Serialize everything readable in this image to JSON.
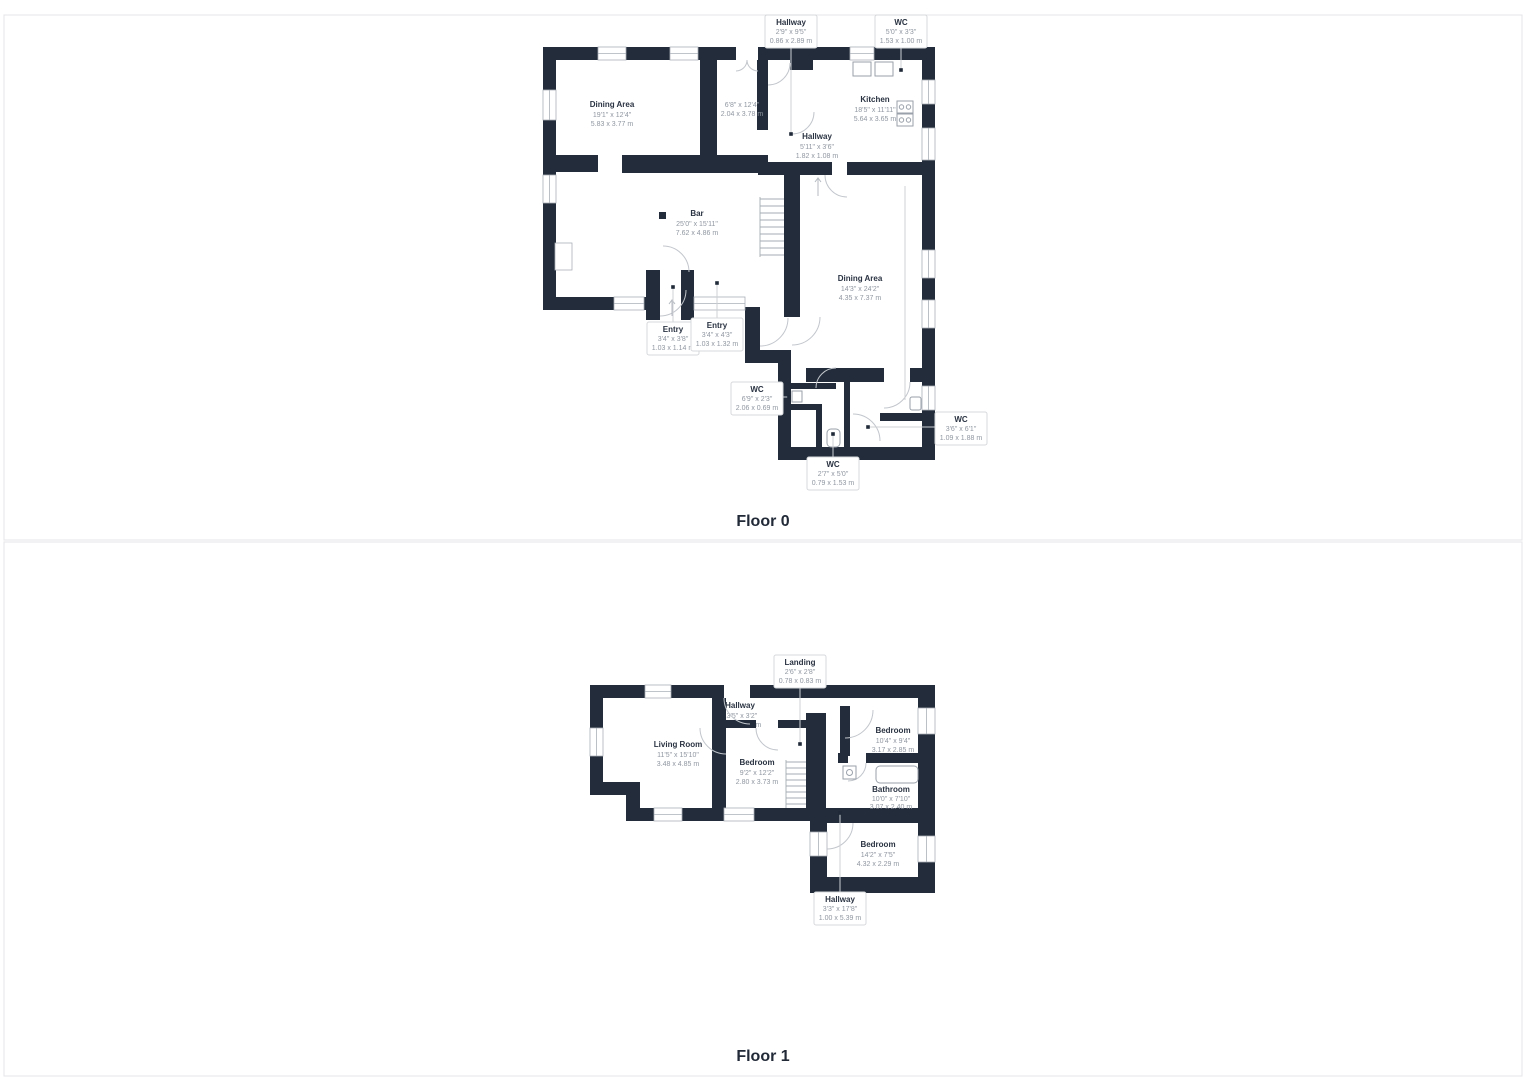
{
  "palette": {
    "wall": "#222c3a",
    "room_name_text": "#2a3342",
    "dimension_text": "#9097a1",
    "leader_line": "#cdd0d4",
    "label_box_border": "#d6d8db",
    "panel_border": "#e4e5e8",
    "background": "#ffffff"
  },
  "floors": [
    {
      "caption": "Floor 0",
      "rooms": [
        {
          "name": "Dining Area",
          "imperial": "19'1\" x 12'4\"",
          "metric": "5.83 x 3.77 m",
          "boxed": false
        },
        {
          "name": "",
          "imperial": "6'8\" x 12'4\"",
          "metric": "2.04 x 3.78 m",
          "boxed": false
        },
        {
          "name": "Kitchen",
          "imperial": "18'5\" x 11'11\"",
          "metric": "5.64 x 3.65 m",
          "boxed": false
        },
        {
          "name": "Hallway",
          "imperial": "5'11\" x 3'6\"",
          "metric": "1.82 x 1.08 m",
          "boxed": false
        },
        {
          "name": "Bar",
          "imperial": "25'0\" x 15'11\"",
          "metric": "7.62 x 4.86 m",
          "boxed": false
        },
        {
          "name": "Dining Area",
          "imperial": "14'3\" x 24'2\"",
          "metric": "4.35 x 7.37 m",
          "boxed": false
        },
        {
          "name": "Hallway",
          "imperial": "2'9\" x 9'5\"",
          "metric": "0.86 x 2.89 m",
          "boxed": true
        },
        {
          "name": "WC",
          "imperial": "5'0\" x 3'3\"",
          "metric": "1.53 x 1.00 m",
          "boxed": true
        },
        {
          "name": "Entry",
          "imperial": "3'4\" x 3'8\"",
          "metric": "1.03 x 1.14 m",
          "boxed": true
        },
        {
          "name": "Entry",
          "imperial": "3'4\" x 4'3\"",
          "metric": "1.03 x 1.32 m",
          "boxed": true
        },
        {
          "name": "WC",
          "imperial": "6'9\" x 2'3\"",
          "metric": "2.06 x 0.69 m",
          "boxed": true
        },
        {
          "name": "WC",
          "imperial": "3'6\" x 6'1\"",
          "metric": "1.09 x 1.88 m",
          "boxed": true
        },
        {
          "name": "WC",
          "imperial": "2'7\" x 5'0\"",
          "metric": "0.79 x 1.53 m",
          "boxed": true
        }
      ]
    },
    {
      "caption": "Floor 1",
      "rooms": [
        {
          "name": "Living Room",
          "imperial": "11'5\" x 15'10\"",
          "metric": "3.48 x 4.85 m",
          "boxed": false
        },
        {
          "name": "Hallway",
          "imperial": "13'5\" x 3'2\"",
          "metric": "4.10 x 0.97 m",
          "boxed": false
        },
        {
          "name": "Bedroom",
          "imperial": "9'2\" x 12'2\"",
          "metric": "2.80 x 3.73 m",
          "boxed": false
        },
        {
          "name": "Bedroom",
          "imperial": "10'4\" x 9'4\"",
          "metric": "3.17 x 2.85 m",
          "boxed": false
        },
        {
          "name": "Bathroom",
          "imperial": "10'0\" x 7'10\"",
          "metric": "3.07 x 2.40 m",
          "boxed": false
        },
        {
          "name": "Bedroom",
          "imperial": "14'2\" x 7'5\"",
          "metric": "4.32 x 2.29 m",
          "boxed": false
        },
        {
          "name": "Landing",
          "imperial": "2'6\" x 2'8\"",
          "metric": "0.78 x 0.83 m",
          "boxed": true
        },
        {
          "name": "Hallway",
          "imperial": "3'3\" x 17'8\"",
          "metric": "1.00 x 5.39 m",
          "boxed": true
        }
      ]
    }
  ]
}
